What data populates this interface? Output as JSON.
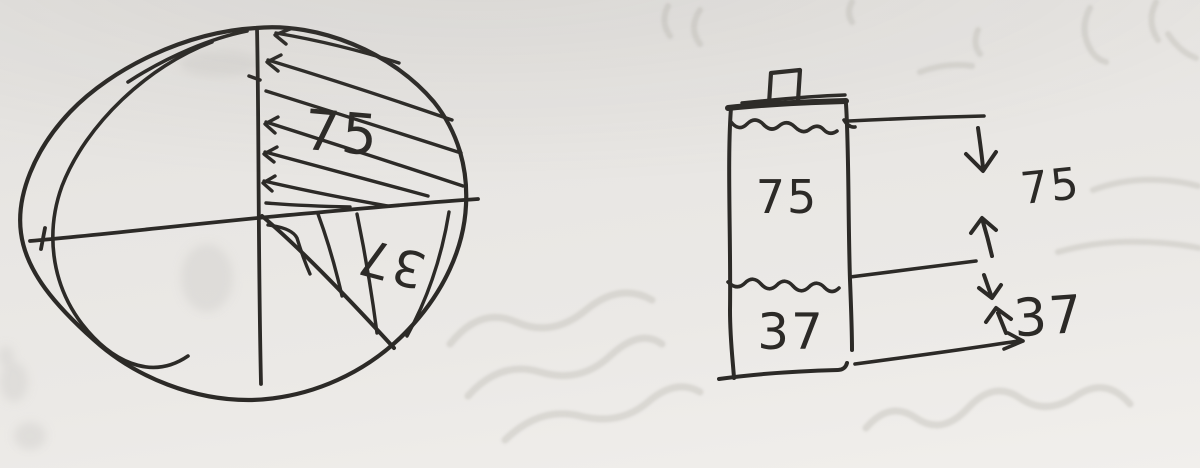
{
  "page": {
    "kind": "photographed hand-drawn sketch",
    "paper_color": "#e9e7e4",
    "ink_color": "#2c2a27",
    "bleedthrough_color": "#c6c3be"
  },
  "pie": {
    "quarter_label": "75",
    "wedge_label": "37"
  },
  "bar": {
    "top_segment_label": "75",
    "bottom_segment_label": "37",
    "dim_top_label": "75",
    "dim_bottom_label": "37"
  },
  "chart_data": [
    {
      "type": "pie",
      "title": "",
      "slices": [
        {
          "label": "75",
          "value": 75,
          "fraction_est": 0.25,
          "fill": "diagonal-hatch",
          "position": "upper-right quadrant"
        },
        {
          "label": "37",
          "value": 37,
          "fraction_est": 0.125,
          "fill": "curved-hatch",
          "position": "wedge below horizontal axis, right side"
        },
        {
          "label": "",
          "value": null,
          "fraction_est": 0.625,
          "fill": "blank",
          "position": "remainder of circle"
        }
      ],
      "layout_hints": "hand-drawn circle split by a vertical and a slightly tilted horizontal diameter; hatch lines drawn as long arrow strokes; wedge label written rotated ~180 degrees"
    },
    {
      "type": "bar",
      "orientation": "vertical",
      "categories": [
        "top segment",
        "bottom segment"
      ],
      "values": [
        75,
        37
      ],
      "segment_labels": [
        "75",
        "37"
      ],
      "dimension_labels": [
        "75",
        "37"
      ],
      "layout_hints": "battery-shaped column with small cap on top, wavy level lines separating segments, right-side dimension lines with down/up arrows marking the 75 span and the 37 span"
    }
  ]
}
